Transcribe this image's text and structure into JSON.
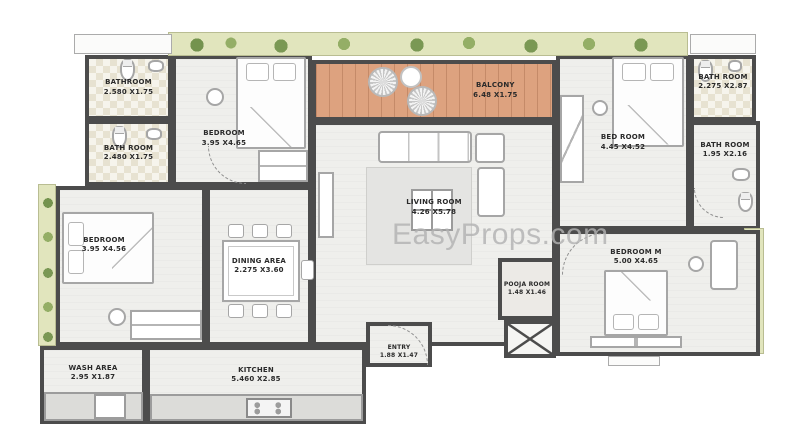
{
  "watermark": {
    "text": "EasyProps.com"
  },
  "rooms": [
    {
      "key": "bathroom-1",
      "name": "BATHROOM",
      "dims": "2.580 X1.75"
    },
    {
      "key": "bathroom-2",
      "name": "BATH ROOM",
      "dims": "2.480 X1.75"
    },
    {
      "key": "bedroom-1",
      "name": "BEDROOM",
      "dims": "3.95 X4.65"
    },
    {
      "key": "balcony",
      "name": "BALCONY",
      "dims": "6.48 X1.75"
    },
    {
      "key": "living-room",
      "name": "LIVING ROOM",
      "dims": "4.26 X5.78"
    },
    {
      "key": "bedroom-2",
      "name": "BED ROOM",
      "dims": "4.45 X4.52"
    },
    {
      "key": "bathroom-3",
      "name": "BATH ROOM",
      "dims": "2.275 X2.87"
    },
    {
      "key": "bathroom-4",
      "name": "BATH ROOM",
      "dims": "1.95 X2.16"
    },
    {
      "key": "master-bedroom",
      "name": "BEDROOM M",
      "dims": "5.00 X4.65"
    },
    {
      "key": "pooja-room",
      "name": "POOJA ROOM",
      "dims": "1.48 X1.46"
    },
    {
      "key": "bedroom-3",
      "name": "BEDROOM",
      "dims": "3.95 X4.56"
    },
    {
      "key": "dining-area",
      "name": "DINING AREA",
      "dims": "2.275 X3.60"
    },
    {
      "key": "kitchen",
      "name": "KITCHEN",
      "dims": "5.460 X2.85"
    },
    {
      "key": "wash-area",
      "name": "WASH AREA",
      "dims": "2.95 X1.87"
    },
    {
      "key": "entry",
      "name": "ENTRY",
      "dims": "1.88 X1.47"
    }
  ],
  "colors": {
    "wall": "#4c4c4c",
    "floor": "#efefec",
    "tile": "#e7e2d1",
    "balcony_floor": "#dda27f",
    "greenery": "#8ca85c",
    "watermark_gray": "#b2b2b2"
  }
}
